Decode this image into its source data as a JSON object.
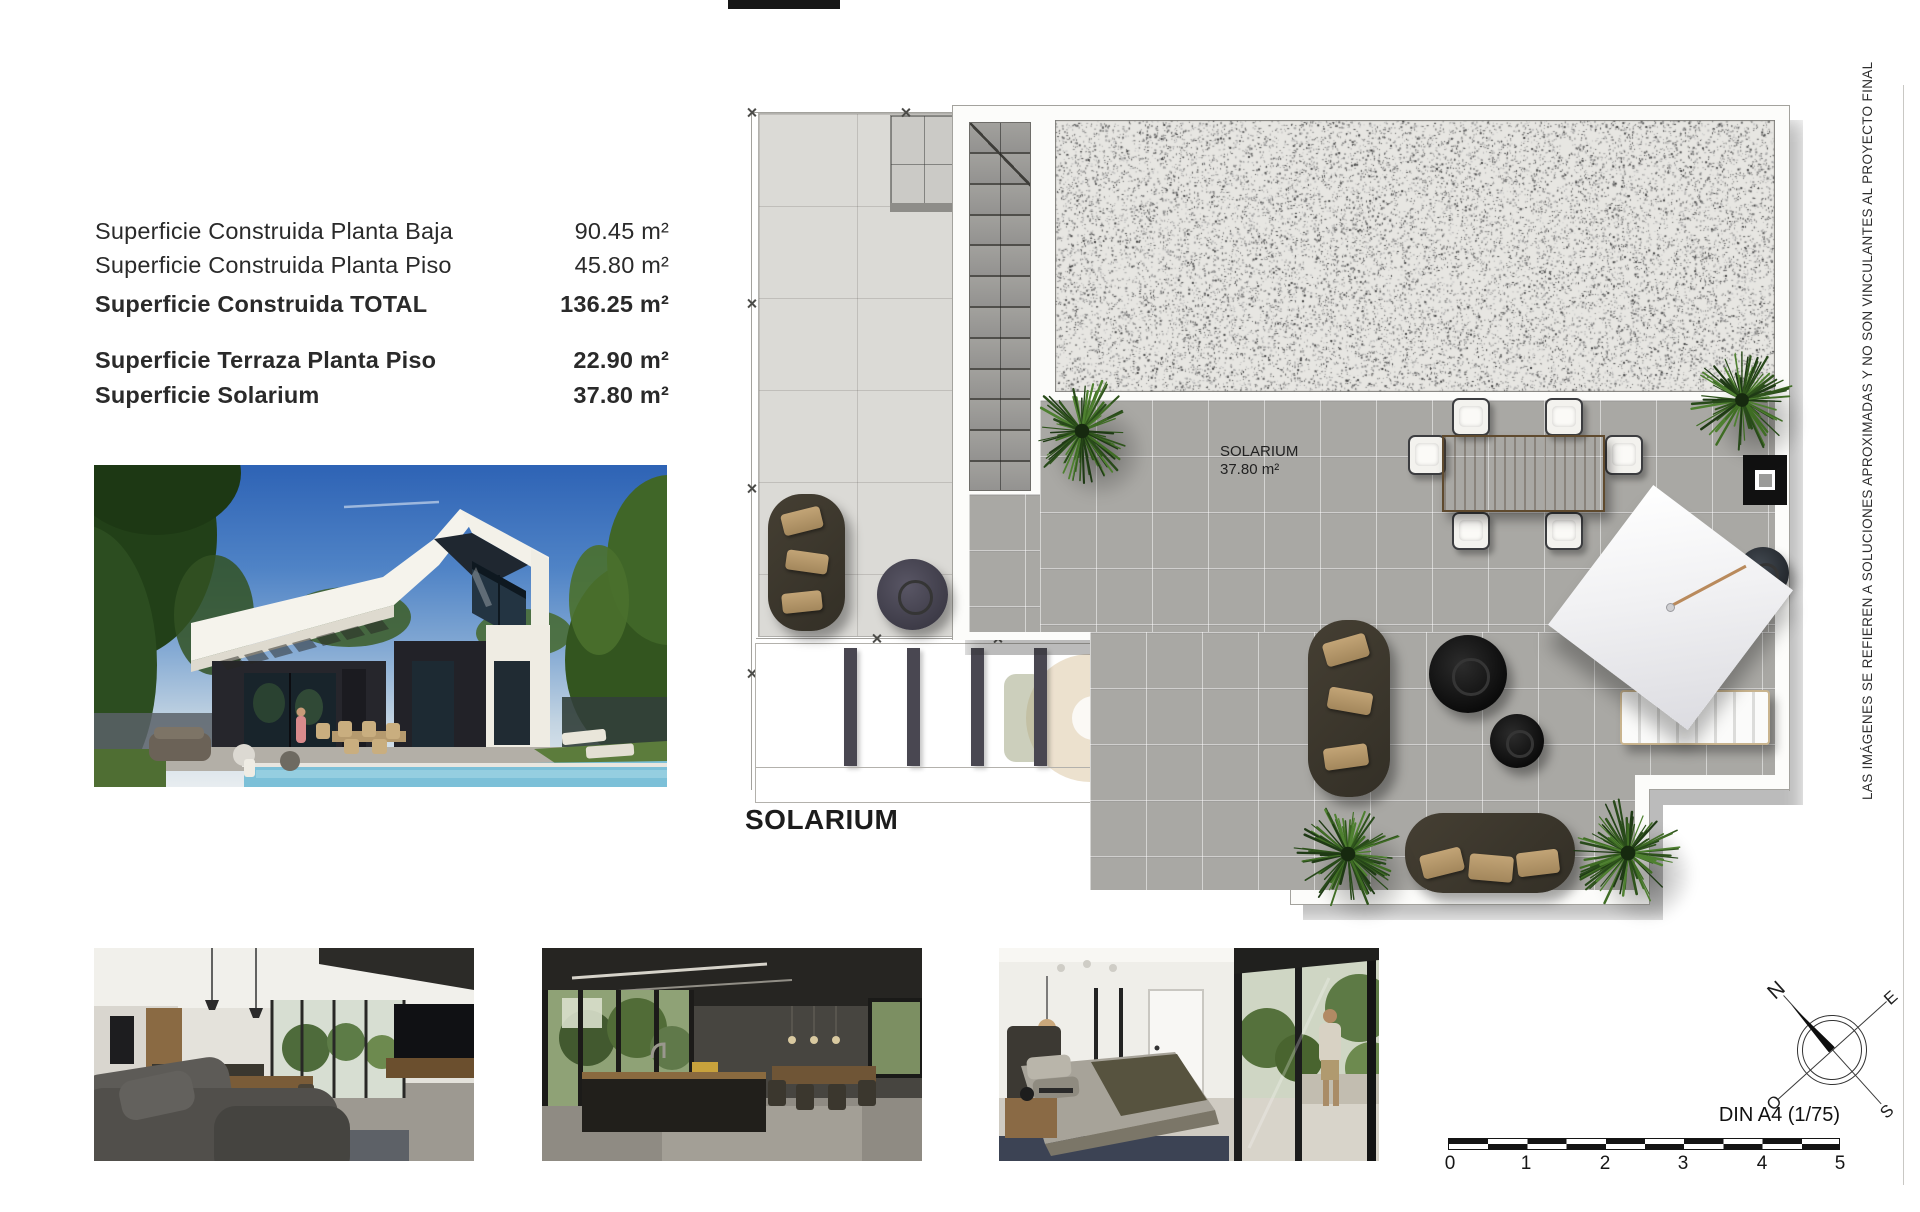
{
  "surfaces": {
    "rows": [
      {
        "label": "Superficie Construida Planta Baja",
        "value": "90.45 m²"
      },
      {
        "label": "Superficie Construida Planta Piso",
        "value": "45.80 m²"
      },
      {
        "label": "Superficie Construida TOTAL",
        "value": "136.25 m²"
      },
      {
        "label": "Superficie Terraza Planta Piso",
        "value": "22.90 m²"
      },
      {
        "label": "Superficie Solarium",
        "value": "37.80 m²"
      }
    ]
  },
  "plan": {
    "caption": "SOLARIUM",
    "room_label": "SOLARIUM",
    "room_area": "37.80 m²"
  },
  "disclaimer": "LAS IMÁGENES SE REFIEREN A SOLUCIONES APROXIMADAS Y NO SON VINCULANTES AL PROYECTO FINAL",
  "scale_bar": {
    "format_label": "DIN A4 (1/75)",
    "ticks": [
      "0",
      "1",
      "2",
      "3",
      "4",
      "5"
    ]
  },
  "compass": {
    "north": "N",
    "east": "E",
    "south": "S",
    "west": "O"
  },
  "colors": {
    "accent_dark": "#141414",
    "plan_tile": "#a9a8a4",
    "terrace_tile": "#dbdad6",
    "plant_green": "#3f6d24"
  }
}
